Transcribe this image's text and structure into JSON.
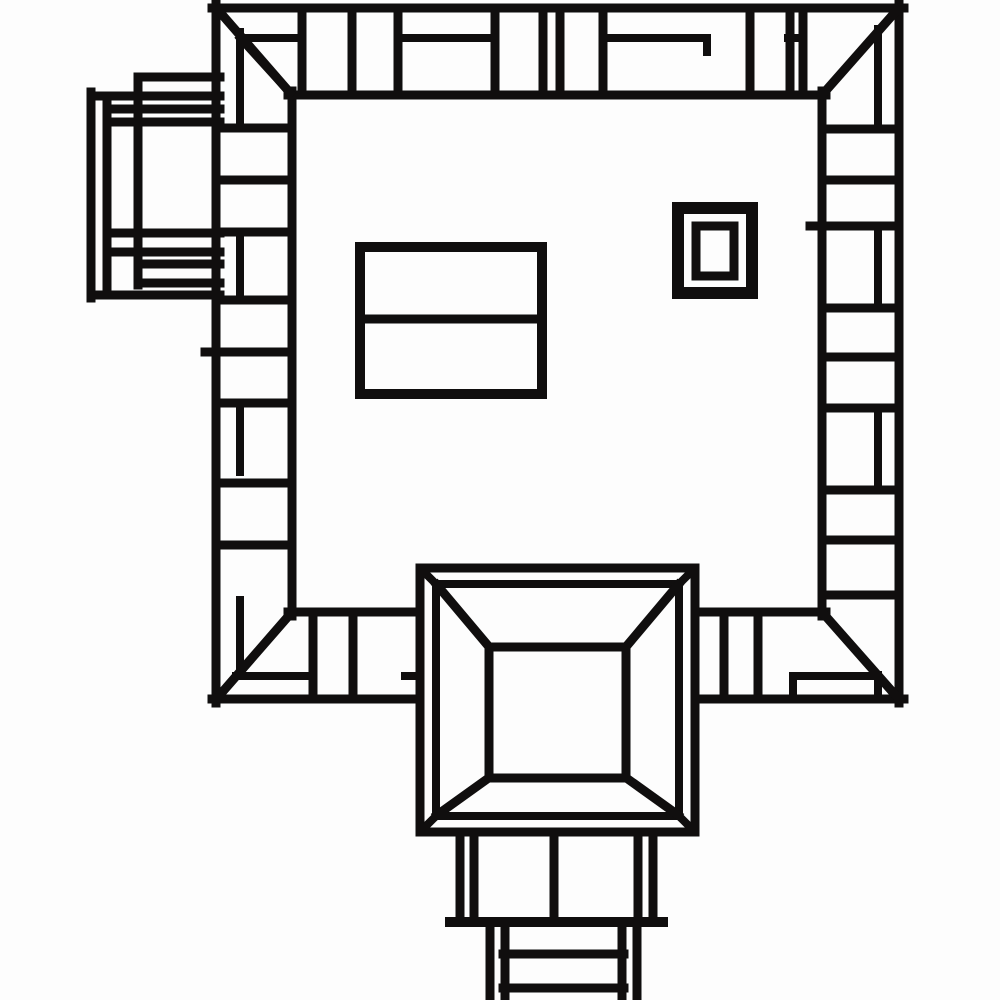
{
  "canvas": {
    "width": 1000,
    "height": 1000,
    "background_color": "#fdfdfd",
    "ink_color": "#100e0e",
    "default_stroke": 9
  },
  "drawing": {
    "description": "monochrome technical plan-view line drawing",
    "components": [
      {
        "name": "frame-outer-edge",
        "shapes": [
          {
            "t": "l",
            "p": [
              212,
              8,
              904,
              8
            ],
            "w": 9
          },
          {
            "t": "l",
            "p": [
              899,
              4,
              899,
              703
            ],
            "w": 9
          },
          {
            "t": "l",
            "p": [
              212,
              699,
              904,
              699
            ],
            "w": 9
          },
          {
            "t": "l",
            "p": [
              216,
              4,
              216,
              703
            ],
            "w": 9
          }
        ]
      },
      {
        "name": "frame-inner-edge",
        "shapes": [
          {
            "t": "l",
            "p": [
              288,
              95,
              826,
              95
            ],
            "w": 9
          },
          {
            "t": "l",
            "p": [
              822,
              91,
              822,
              616
            ],
            "w": 9
          },
          {
            "t": "l",
            "p": [
              288,
              612,
              826,
              612
            ],
            "w": 9
          },
          {
            "t": "l",
            "p": [
              292,
              91,
              292,
              616
            ],
            "w": 9
          }
        ]
      },
      {
        "name": "frame-corner-miters",
        "shapes": [
          {
            "t": "l",
            "p": [
              218,
              10,
              292,
              95
            ],
            "w": 9
          },
          {
            "t": "l",
            "p": [
              897,
              10,
              822,
              95
            ],
            "w": 9
          },
          {
            "t": "l",
            "p": [
              292,
              612,
              218,
              697
            ],
            "w": 9
          },
          {
            "t": "l",
            "p": [
              822,
              612,
              897,
              697
            ],
            "w": 9
          }
        ]
      },
      {
        "name": "frame-corner-offset-diagonals",
        "shapes": [
          {
            "t": "l",
            "p": [
              240,
              38,
              290,
              93
            ],
            "w": 8
          },
          {
            "t": "l",
            "p": [
              236,
              676,
              219,
              696
            ],
            "w": 8
          }
        ]
      },
      {
        "name": "top-wall-dividers",
        "shapes": [
          {
            "t": "l",
            "p": [
              302,
              8,
              302,
              95
            ],
            "w": 9
          },
          {
            "t": "l",
            "p": [
              352,
              8,
              352,
              95
            ],
            "w": 9
          },
          {
            "t": "l",
            "p": [
              398,
              8,
              398,
              95
            ],
            "w": 9
          },
          {
            "t": "l",
            "p": [
              495,
              8,
              495,
              95
            ],
            "w": 9
          },
          {
            "t": "l",
            "p": [
              543,
              8,
              543,
              95
            ],
            "w": 9
          },
          {
            "t": "l",
            "p": [
              560,
              8,
              560,
              95
            ],
            "w": 9
          },
          {
            "t": "l",
            "p": [
              603,
              8,
              603,
              95
            ],
            "w": 9
          },
          {
            "t": "l",
            "p": [
              750,
              8,
              750,
              95
            ],
            "w": 9
          },
          {
            "t": "l",
            "p": [
              790,
              8,
              790,
              95
            ],
            "w": 9
          },
          {
            "t": "l",
            "p": [
              803,
              8,
              803,
              95
            ],
            "w": 9
          }
        ]
      },
      {
        "name": "top-wall-midlines",
        "shapes": [
          {
            "t": "l",
            "p": [
              246,
              38,
              302,
              38
            ],
            "w": 8
          },
          {
            "t": "l",
            "p": [
              398,
              38,
              495,
              38
            ],
            "w": 8
          },
          {
            "t": "l",
            "p": [
              603,
              38,
              707,
              38
            ],
            "w": 8
          },
          {
            "t": "l",
            "p": [
              707,
              38,
              707,
              52
            ],
            "w": 8
          },
          {
            "t": "l",
            "p": [
              788,
              38,
              803,
              38
            ],
            "w": 8
          }
        ]
      },
      {
        "name": "left-wall-dividers",
        "shapes": [
          {
            "t": "l",
            "p": [
              216,
              128,
              292,
              128
            ],
            "w": 9
          },
          {
            "t": "l",
            "p": [
              216,
              180,
              292,
              180
            ],
            "w": 9
          },
          {
            "t": "l",
            "p": [
              216,
              232,
              292,
              232
            ],
            "w": 9
          },
          {
            "t": "l",
            "p": [
              216,
              300,
              292,
              300
            ],
            "w": 9
          },
          {
            "t": "l",
            "p": [
              205,
              352,
              292,
              352
            ],
            "w": 9
          },
          {
            "t": "l",
            "p": [
              216,
              403,
              292,
              403
            ],
            "w": 9
          },
          {
            "t": "l",
            "p": [
              216,
              483,
              292,
              483
            ],
            "w": 9
          },
          {
            "t": "l",
            "p": [
              216,
              545,
              292,
              545
            ],
            "w": 9
          }
        ]
      },
      {
        "name": "left-wall-midlines",
        "shapes": [
          {
            "t": "l",
            "p": [
              240,
              32,
              240,
              128
            ],
            "w": 8
          },
          {
            "t": "l",
            "p": [
              240,
              232,
              240,
              300
            ],
            "w": 8
          },
          {
            "t": "l",
            "p": [
              240,
              403,
              240,
              472
            ],
            "w": 8
          },
          {
            "t": "l",
            "p": [
              240,
              600,
              240,
              671
            ],
            "w": 8
          },
          {
            "t": "l",
            "p": [
              236,
              676,
              313,
              676
            ],
            "w": 8
          }
        ]
      },
      {
        "name": "right-wall-dividers",
        "shapes": [
          {
            "t": "l",
            "p": [
              822,
              129,
              899,
              129
            ],
            "w": 9
          },
          {
            "t": "l",
            "p": [
              822,
              180,
              899,
              180
            ],
            "w": 9
          },
          {
            "t": "l",
            "p": [
              810,
              226,
              899,
              226
            ],
            "w": 9
          },
          {
            "t": "l",
            "p": [
              822,
              308,
              899,
              308
            ],
            "w": 9
          },
          {
            "t": "l",
            "p": [
              822,
              357,
              899,
              357
            ],
            "w": 9
          },
          {
            "t": "l",
            "p": [
              822,
              408,
              899,
              408
            ],
            "w": 9
          },
          {
            "t": "l",
            "p": [
              822,
              490,
              899,
              490
            ],
            "w": 9
          },
          {
            "t": "l",
            "p": [
              822,
              540,
              899,
              540
            ],
            "w": 9
          },
          {
            "t": "l",
            "p": [
              822,
              595,
              899,
              595
            ],
            "w": 9
          }
        ]
      },
      {
        "name": "right-wall-midlines",
        "shapes": [
          {
            "t": "l",
            "p": [
              878,
              29,
              878,
              129
            ],
            "w": 8
          },
          {
            "t": "l",
            "p": [
              878,
              226,
              878,
              308
            ],
            "w": 8
          },
          {
            "t": "l",
            "p": [
              878,
              408,
              878,
              483
            ],
            "w": 8
          },
          {
            "t": "l",
            "p": [
              878,
              675,
              878,
              699
            ],
            "w": 8
          },
          {
            "t": "l",
            "p": [
              793,
              676,
              878,
              676
            ],
            "w": 8
          },
          {
            "t": "l",
            "p": [
              793,
              676,
              793,
              699
            ],
            "w": 8
          }
        ]
      },
      {
        "name": "bottom-wall-dividers",
        "shapes": [
          {
            "t": "l",
            "p": [
              313,
              612,
              313,
              699
            ],
            "w": 9
          },
          {
            "t": "l",
            "p": [
              353,
              612,
              353,
              699
            ],
            "w": 9
          },
          {
            "t": "l",
            "p": [
              724,
              612,
              724,
              699
            ],
            "w": 9
          },
          {
            "t": "l",
            "p": [
              758,
              612,
              758,
              699
            ],
            "w": 9
          }
        ]
      },
      {
        "name": "bottom-wall-midlines",
        "shapes": [
          {
            "t": "l",
            "p": [
              405,
              676,
              421,
              676
            ],
            "w": 8
          }
        ]
      },
      {
        "name": "left-annex",
        "shapes": [
          {
            "t": "l",
            "p": [
              91,
              92,
              91,
              298
            ],
            "w": 9
          },
          {
            "t": "l",
            "p": [
              107,
              105,
              107,
              295
            ],
            "w": 9
          },
          {
            "t": "l",
            "p": [
              138,
              77,
              138,
              285
            ],
            "w": 9
          },
          {
            "t": "l",
            "p": [
              138,
              77,
              220,
              77
            ],
            "w": 9
          },
          {
            "t": "l",
            "p": [
              91,
              96,
              220,
              96
            ],
            "w": 9
          },
          {
            "t": "l",
            "p": [
              107,
              109,
              220,
              109
            ],
            "w": 9
          },
          {
            "t": "l",
            "p": [
              107,
              122,
              220,
              122
            ],
            "w": 9
          },
          {
            "t": "l",
            "p": [
              107,
              233,
              220,
              233
            ],
            "w": 9
          },
          {
            "t": "l",
            "p": [
              107,
              252,
              220,
              252
            ],
            "w": 9
          },
          {
            "t": "l",
            "p": [
              138,
              264,
              220,
              264
            ],
            "w": 9
          },
          {
            "t": "l",
            "p": [
              138,
              283,
              220,
              283
            ],
            "w": 9
          },
          {
            "t": "l",
            "p": [
              91,
              295,
              220,
              295
            ],
            "w": 9
          }
        ]
      },
      {
        "name": "inner-hall-rectangle",
        "shapes": [
          {
            "t": "r",
            "p": [
              360,
              247,
              182,
              147
            ],
            "w": 10
          },
          {
            "t": "l",
            "p": [
              360,
              319,
              542,
              319
            ],
            "w": 9
          }
        ]
      },
      {
        "name": "small-double-square",
        "shapes": [
          {
            "t": "r",
            "p": [
              678,
              208,
              74,
              85
            ],
            "w": 12
          },
          {
            "t": "r",
            "p": [
              696,
              226,
              38,
              50
            ],
            "w": 9
          }
        ]
      },
      {
        "name": "gate-pyramid-roof",
        "shapes": [
          {
            "t": "r",
            "p": [
              420,
              568,
              275,
              264
            ],
            "w": 9,
            "f": "bg"
          },
          {
            "t": "r",
            "p": [
              436,
              584,
              243,
              232
            ],
            "w": 8
          },
          {
            "t": "l",
            "p": [
              422,
              570,
              436,
              584
            ],
            "w": 8
          },
          {
            "t": "l",
            "p": [
              693,
              570,
              679,
              584
            ],
            "w": 8
          },
          {
            "t": "l",
            "p": [
              422,
              830,
              436,
              816
            ],
            "w": 8
          },
          {
            "t": "l",
            "p": [
              693,
              830,
              679,
              816
            ],
            "w": 8
          },
          {
            "t": "l",
            "p": [
              437,
              585,
              490,
              648
            ],
            "w": 9
          },
          {
            "t": "l",
            "p": [
              678,
              585,
              625,
              648
            ],
            "w": 9
          },
          {
            "t": "l",
            "p": [
              437,
              815,
              490,
              777
            ],
            "w": 9
          },
          {
            "t": "l",
            "p": [
              678,
              815,
              625,
              777
            ],
            "w": 9
          },
          {
            "t": "r",
            "p": [
              489,
              647,
              137,
              131
            ],
            "w": 9
          }
        ]
      },
      {
        "name": "gate-tower-base",
        "shapes": [
          {
            "t": "l",
            "p": [
              460,
              832,
              460,
              922
            ],
            "w": 9
          },
          {
            "t": "l",
            "p": [
              474,
              832,
              474,
              922
            ],
            "w": 9
          },
          {
            "t": "l",
            "p": [
              554,
              832,
              554,
              922
            ],
            "w": 9
          },
          {
            "t": "l",
            "p": [
              638,
              832,
              638,
              922
            ],
            "w": 9
          },
          {
            "t": "l",
            "p": [
              653,
              832,
              653,
              922
            ],
            "w": 9
          },
          {
            "t": "l",
            "p": [
              450,
              922,
              663,
              922
            ],
            "w": 10
          },
          {
            "t": "l",
            "p": [
              490,
              922,
              490,
              998
            ],
            "w": 9
          },
          {
            "t": "l",
            "p": [
              505,
              922,
              505,
              998
            ],
            "w": 9
          },
          {
            "t": "l",
            "p": [
              622,
              922,
              622,
              998
            ],
            "w": 9
          },
          {
            "t": "l",
            "p": [
              637,
              922,
              637,
              998
            ],
            "w": 9
          },
          {
            "t": "l",
            "p": [
              503,
              954,
              624,
              954
            ],
            "w": 9
          },
          {
            "t": "l",
            "p": [
              503,
              988,
              624,
              988
            ],
            "w": 9
          }
        ]
      }
    ]
  }
}
